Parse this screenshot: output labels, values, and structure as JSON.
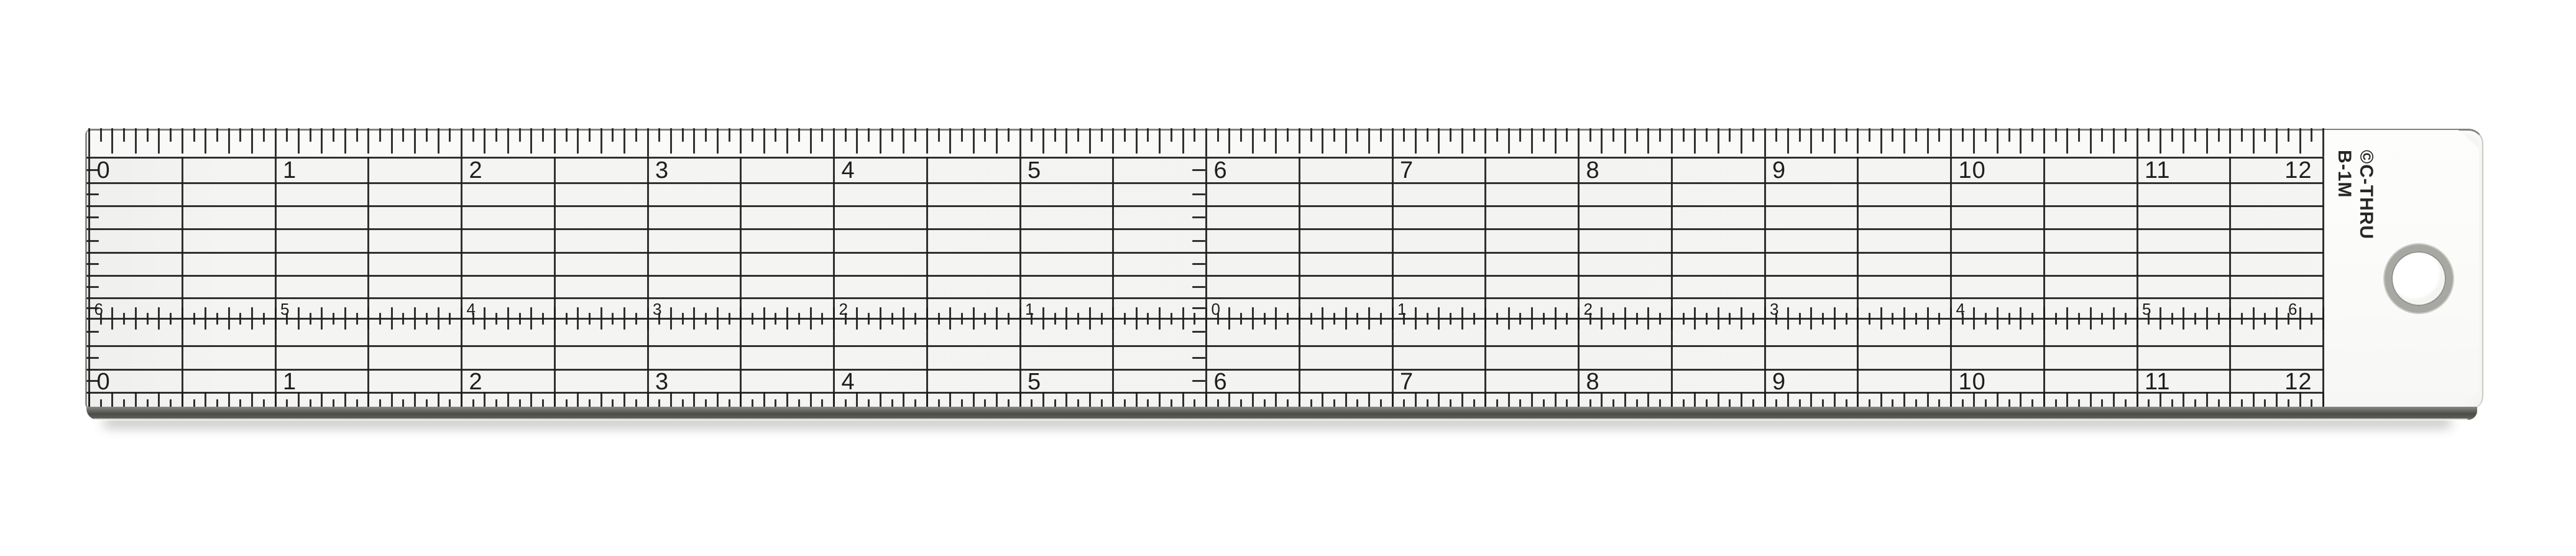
{
  "ruler": {
    "brand": {
      "line1": "©C-THRU",
      "line2": "B-1M"
    },
    "top_scale": {
      "unit": "inches",
      "numbers": [
        "0",
        "1",
        "2",
        "3",
        "4",
        "5",
        "6",
        "7",
        "8",
        "9",
        "10",
        "11",
        "12"
      ]
    },
    "bottom_scale": {
      "unit": "inches",
      "numbers": [
        "0",
        "1",
        "2",
        "3",
        "4",
        "5",
        "6",
        "7",
        "8",
        "9",
        "10",
        "11",
        "12"
      ]
    },
    "center_scale": {
      "description": "centering scale, zero at 6 inches",
      "numbers": [
        "6",
        "5",
        "4",
        "3",
        "2",
        "1",
        "0",
        "1",
        "2",
        "3",
        "4",
        "5",
        "6"
      ]
    },
    "colors": {
      "ink": "#201e1c",
      "body": "#f4f4f2",
      "end_cap": "#fbfbfa",
      "bottom_edge": "#4c4c48",
      "hole_ring": "#a8a8a3",
      "background": "#ffffff"
    }
  }
}
